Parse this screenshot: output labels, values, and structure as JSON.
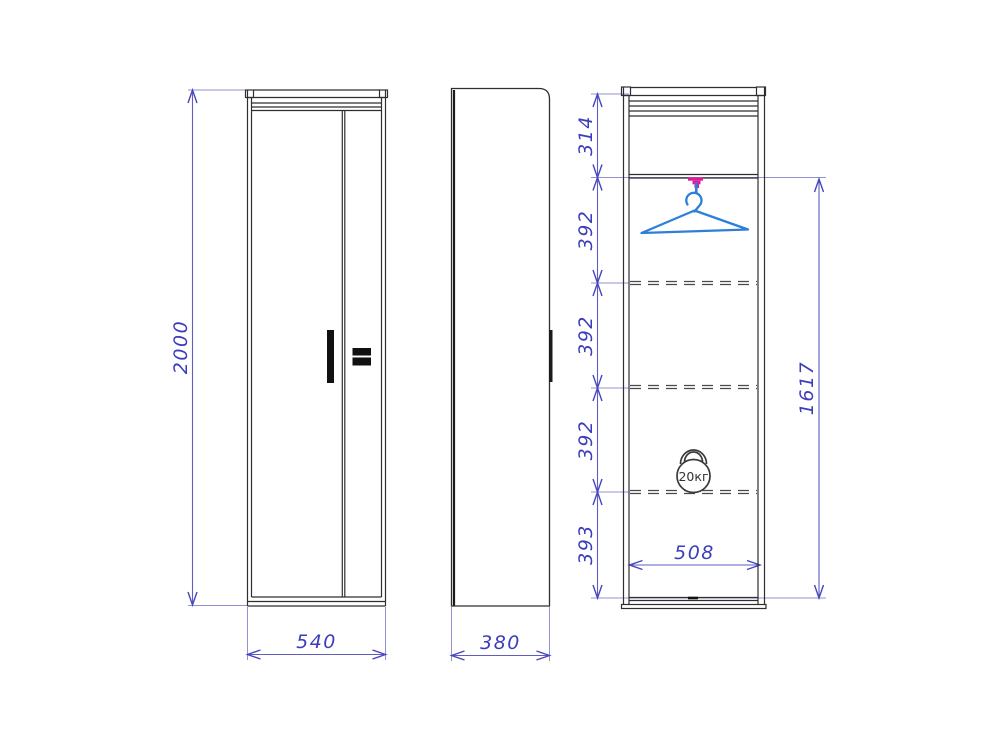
{
  "drawing": {
    "type": "furniture-technical-drawing",
    "views": [
      "front",
      "side",
      "internal-section"
    ],
    "dimensions": {
      "front_height": "2000",
      "front_width": "540",
      "side_depth": "380",
      "section_segments": [
        "314",
        "392",
        "392",
        "392",
        "393"
      ],
      "section_inner_height": "1617",
      "section_inner_width": "508"
    },
    "annotations": {
      "load_capacity": "20кг"
    },
    "icons": [
      "hanger-icon",
      "hanger-bracket-icon",
      "kettlebell-icon"
    ],
    "colors": {
      "outline": "#2f2f2f",
      "dimension_text": "#3d3dbb",
      "dimension_line": "#5d5dc2",
      "extension_line": "#9191d6",
      "hanger_blue": "#2e7fd8",
      "bracket_magenta": "#e0189a",
      "handle_black": "#111111",
      "background": "#ffffff"
    }
  }
}
